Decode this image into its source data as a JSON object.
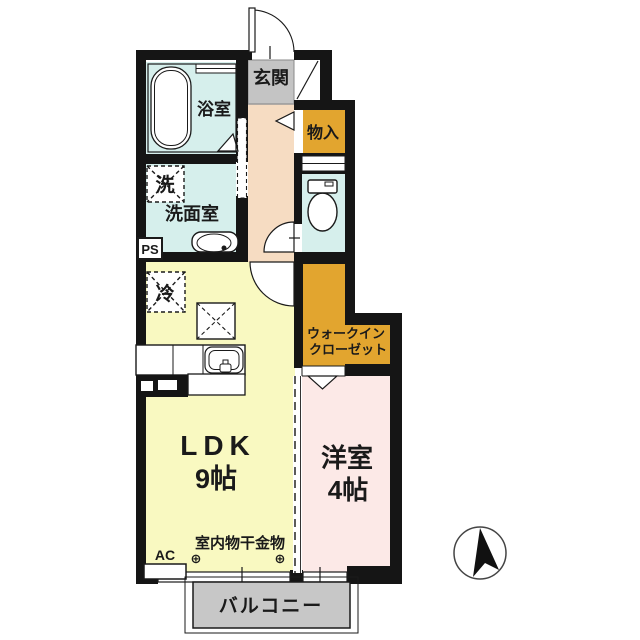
{
  "colors": {
    "wall": "#151515",
    "wet_area": "#d6efec",
    "hallway": "#f6dcc2",
    "genkan": "#c4c4c4",
    "storage": "#e2a52f",
    "ldk": "#f9f9c1",
    "western_room": "#fce9e7",
    "balcony": "#c7c7c7",
    "line": "#1a1a1a"
  },
  "rooms": {
    "genkan": {
      "label": "玄関"
    },
    "bathroom": {
      "label": "浴室"
    },
    "laundry_box": {
      "label": "洗"
    },
    "washroom": {
      "label": "洗面室"
    },
    "pipe_space": {
      "label": "PS"
    },
    "storage": {
      "label": "物入"
    },
    "refrigerator": {
      "label": "冷"
    },
    "walk_in_closet": {
      "line1": "ウォークイン",
      "line2": "クローゼット"
    },
    "ldk": {
      "label": "LDK",
      "size": "9帖"
    },
    "western_room": {
      "label": "洋室",
      "size": "4帖"
    },
    "balcony": {
      "label": "バルコニー"
    }
  },
  "annotations": {
    "ac_unit": "AC",
    "indoor_drying_hardware": "室内物干金物",
    "hook_left": "⊕",
    "hook_right": "⊕"
  }
}
